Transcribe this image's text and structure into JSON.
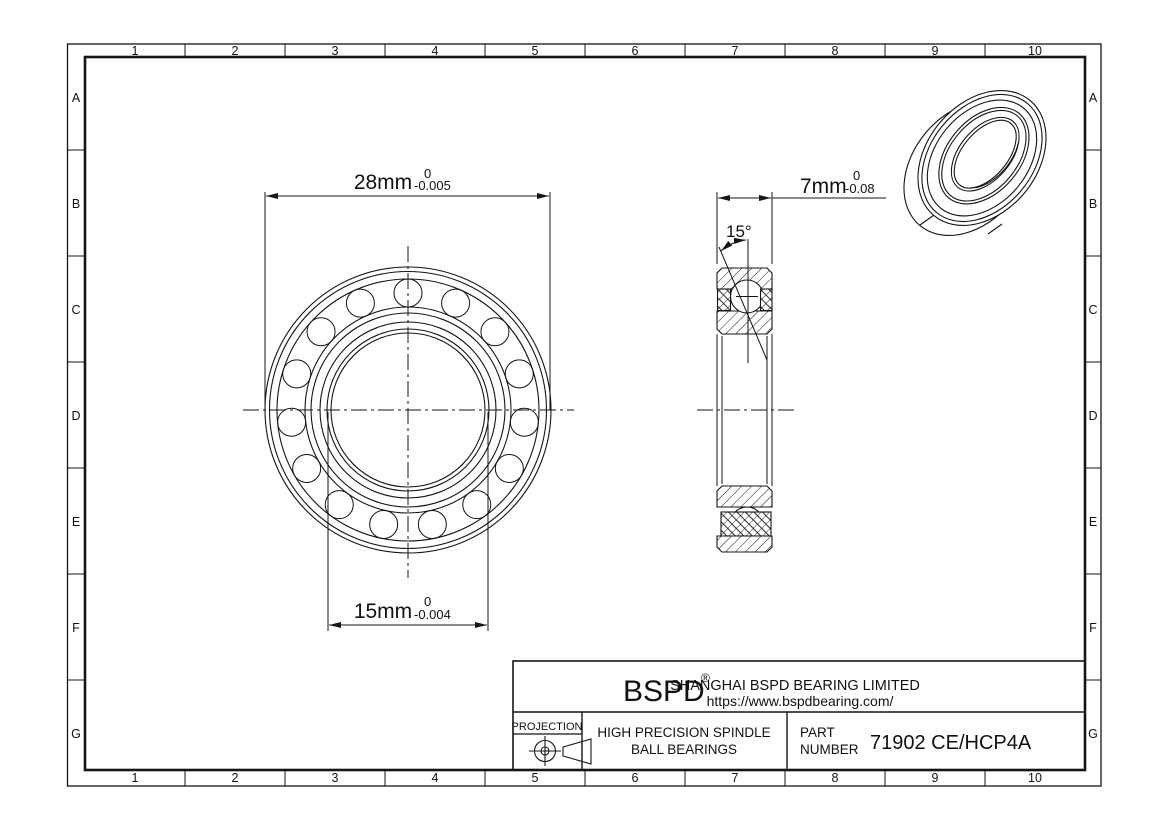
{
  "drawing": {
    "grid": {
      "cols": [
        "1",
        "2",
        "3",
        "4",
        "5",
        "6",
        "7",
        "8",
        "9",
        "10"
      ],
      "rows": [
        "A",
        "B",
        "C",
        "D",
        "E",
        "F",
        "G"
      ]
    },
    "front_view": {
      "dim_outer": {
        "value": "28mm",
        "tol_upper": "0",
        "tol_lower": "-0.005"
      },
      "dim_bore": {
        "value": "15mm",
        "tol_upper": "0",
        "tol_lower": "-0.004"
      }
    },
    "side_view": {
      "dim_width": {
        "value": "7mm",
        "tol_upper": "0",
        "tol_lower": "-0.08"
      },
      "contact_angle": "15°"
    },
    "title_block": {
      "logo": "BSPD",
      "logo_mark": "®",
      "company": "SHANGHAI BSPD BEARING LIMITED",
      "website": "https://www.bspdbearing.com/",
      "projection_label": "PROJECTION",
      "product_line1": "HIGH  PRECISION SPINDLE",
      "product_line2": "BALL BEARINGS",
      "part_label_line1": "PART",
      "part_label_line2": "NUMBER",
      "part_number": "71902 CE/HCP4A"
    },
    "colors": {
      "line": "#151515",
      "background": "#ffffff"
    }
  }
}
